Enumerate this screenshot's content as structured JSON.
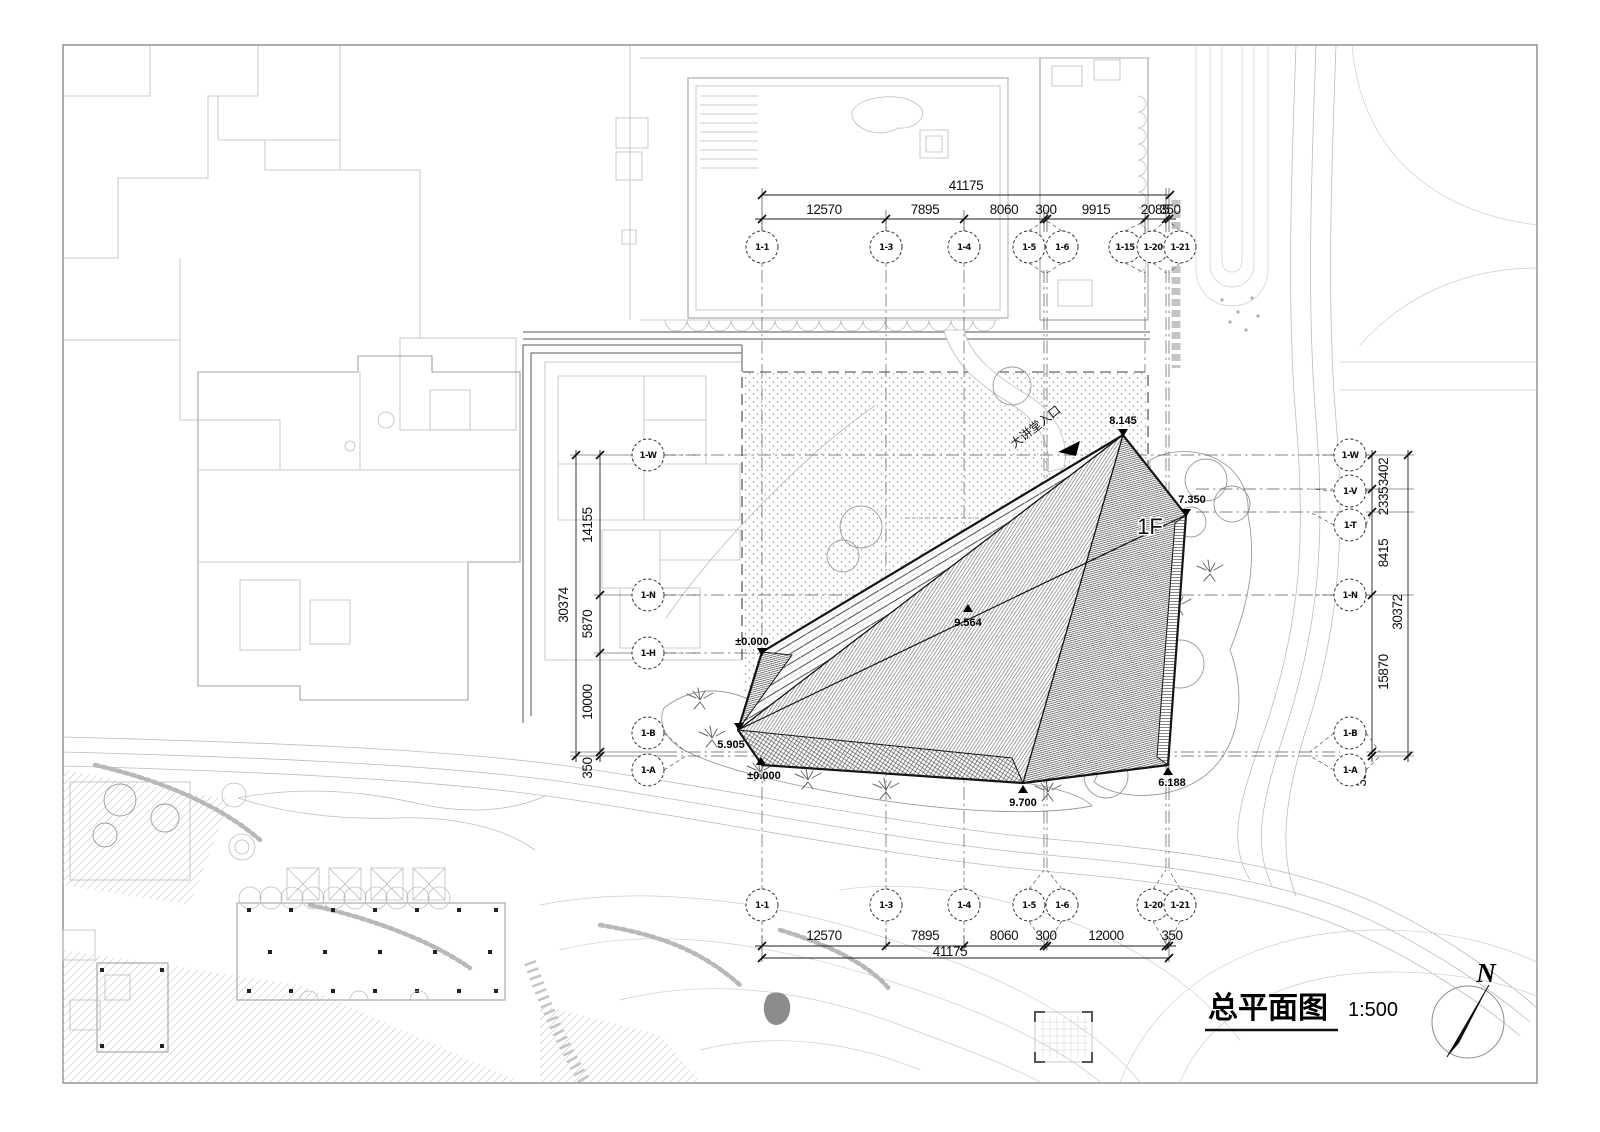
{
  "sheet": {
    "title": "总平面图",
    "scale": "1:500",
    "north_label": "N"
  },
  "plan": {
    "floor_label": "1F",
    "entrance_label": "大讲堂入口"
  },
  "lv": {
    "apex": "8.145",
    "east": "7.350",
    "ridge": "9.564",
    "nw": "±0.000",
    "west": "5.905",
    "sw": "±0.000",
    "south": "9.700",
    "se": "6.188"
  },
  "grid": {
    "top": [
      "1-1",
      "1-3",
      "1-4",
      "1-5",
      "1-6",
      "1-15",
      "1-20",
      "1-21"
    ],
    "bottom": [
      "1-1",
      "1-3",
      "1-4",
      "1-5",
      "1-6",
      "1-20",
      "1-21"
    ],
    "left": [
      "1-W",
      "1-N",
      "1-H",
      "1-B",
      "1-A"
    ],
    "right": [
      "1-W",
      "1-V",
      "1-T",
      "1-N",
      "1-B",
      "1-A"
    ]
  },
  "dim": {
    "top": {
      "total": "41175",
      "seg": [
        "12570",
        "7895",
        "8060",
        "300",
        "9915",
        "2085",
        "350"
      ]
    },
    "bottom": {
      "total": "41175",
      "seg": [
        "12570",
        "7895",
        "8060",
        "300",
        "12000",
        "350"
      ]
    },
    "left": {
      "total": "30374",
      "seg": [
        "14155",
        "5870",
        "10000",
        "350"
      ]
    },
    "right": {
      "total": "30372",
      "seg": [
        "3402",
        "2335",
        "8415",
        "15870",
        "350"
      ]
    }
  }
}
